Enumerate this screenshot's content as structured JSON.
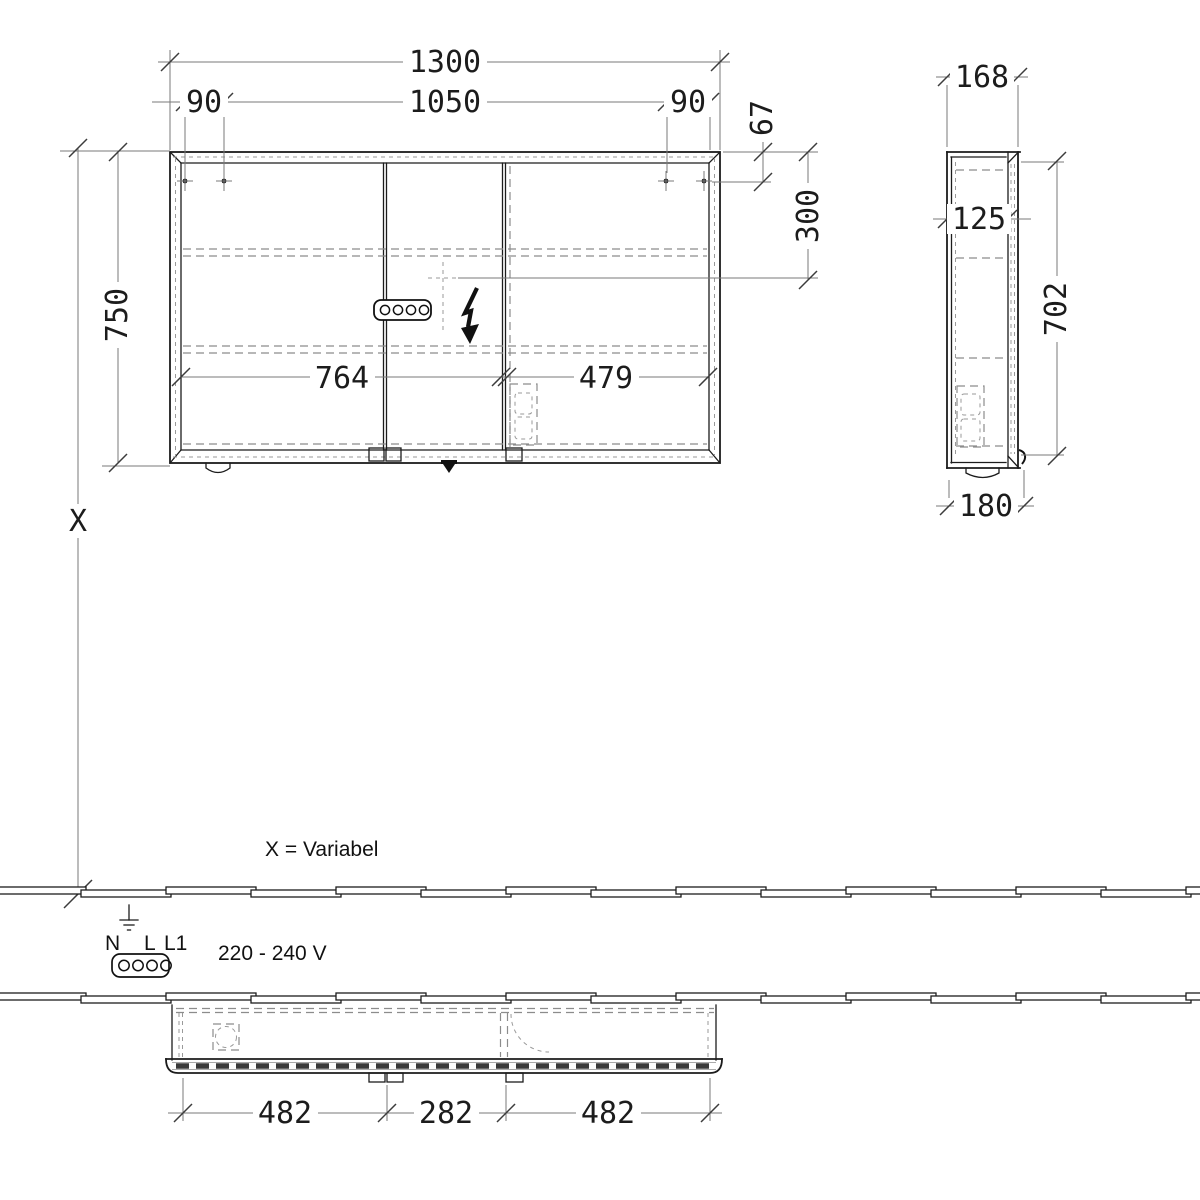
{
  "drawing": {
    "front": {
      "total_width": "1300",
      "hole_span": "1050",
      "hole_offset_left": "90",
      "hole_offset_right": "90",
      "hole_top_offset": "67",
      "socket_offset": "300",
      "height": "750",
      "door_width_left": "764",
      "door_width_right": "479",
      "variable_height_symbol": "X"
    },
    "side": {
      "depth": "168",
      "inner_depth": "125",
      "door_height": "702",
      "total_depth": "180"
    },
    "bottom": {
      "span_left": "482",
      "span_center": "282",
      "span_right": "482"
    },
    "notes": {
      "variable_note": "X = Variabel",
      "voltage_range": "220 - 240 V",
      "terminal_n": "N",
      "terminal_l": "L",
      "terminal_l1": "L1"
    }
  },
  "colors": {
    "object_line": "#1c1c1c",
    "dimension_line": "#7a7a7a",
    "hidden_line": "#8c8c8c",
    "text": "#1c1c1c",
    "background": "#ffffff"
  }
}
